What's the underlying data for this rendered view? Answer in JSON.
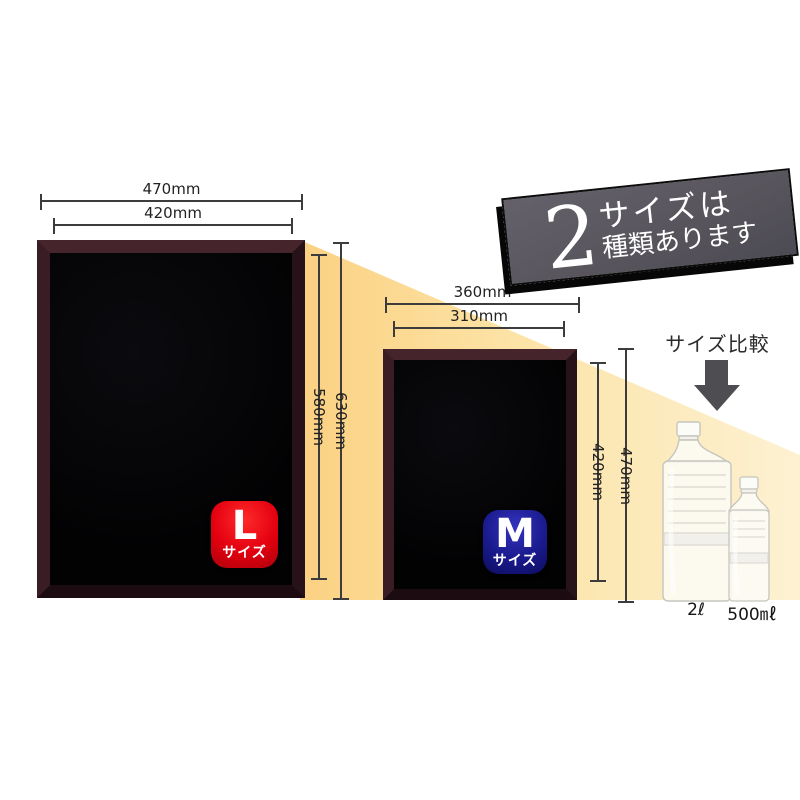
{
  "banner": {
    "number": "2",
    "line1": "サイズは",
    "line2": "種類あります"
  },
  "comparison": {
    "label": "サイズ比較"
  },
  "boards": {
    "large": {
      "badge_letter": "L",
      "badge_suffix": "サイズ",
      "outer_width": "470mm",
      "inner_width": "420mm",
      "outer_height": "630mm",
      "inner_height": "580mm"
    },
    "medium": {
      "badge_letter": "M",
      "badge_suffix": "サイズ",
      "outer_width": "360mm",
      "inner_width": "310mm",
      "outer_height": "470mm",
      "inner_height": "420mm"
    }
  },
  "bottles": {
    "large": {
      "label": "2ℓ"
    },
    "small": {
      "label": "500㎖"
    }
  },
  "colors": {
    "yellow-deep": "#fbd182",
    "yellow-mid": "#fce4a8",
    "yellow-light": "#fdf1d2",
    "banner-gray": "#57545c",
    "badge-red": "#e3000f",
    "badge-blue": "#1a1a8e",
    "dim-line": "#3c3c3c",
    "arrow-gray": "#4e4e52"
  }
}
